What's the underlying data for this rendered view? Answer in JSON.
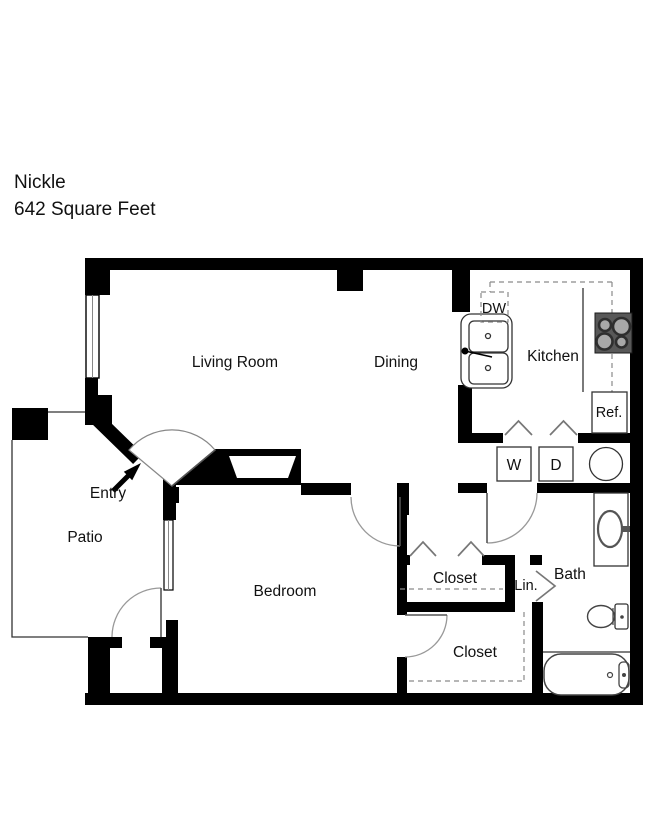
{
  "title": "Nickle",
  "subtitle": "642 Square Feet",
  "rooms": {
    "living_room": {
      "label": "Living Room"
    },
    "dining": {
      "label": "Dining"
    },
    "kitchen": {
      "label": "Kitchen"
    },
    "bedroom": {
      "label": "Bedroom"
    },
    "patio": {
      "label": "Patio"
    },
    "bath": {
      "label": "Bath"
    },
    "entry": {
      "label": "Entry"
    },
    "hall_closet": {
      "label": "Closet"
    },
    "bedroom_closet": {
      "label": "Closet"
    },
    "linen_closet": {
      "label": "Lin."
    }
  },
  "appliances": {
    "dishwasher": {
      "label": "DW"
    },
    "refrigerator": {
      "label": "Ref."
    },
    "washer": {
      "label": "W"
    },
    "dryer": {
      "label": "D"
    }
  },
  "colors": {
    "wall": "#000000",
    "background": "#ffffff",
    "fixture_line": "#333333",
    "door_arc": "#999999",
    "dash_line": "#8a8a8a",
    "stove_body": "#585858",
    "burner_center": "#a8a8a8",
    "burner_ring": "#2e2e2e",
    "text": "#111111"
  }
}
